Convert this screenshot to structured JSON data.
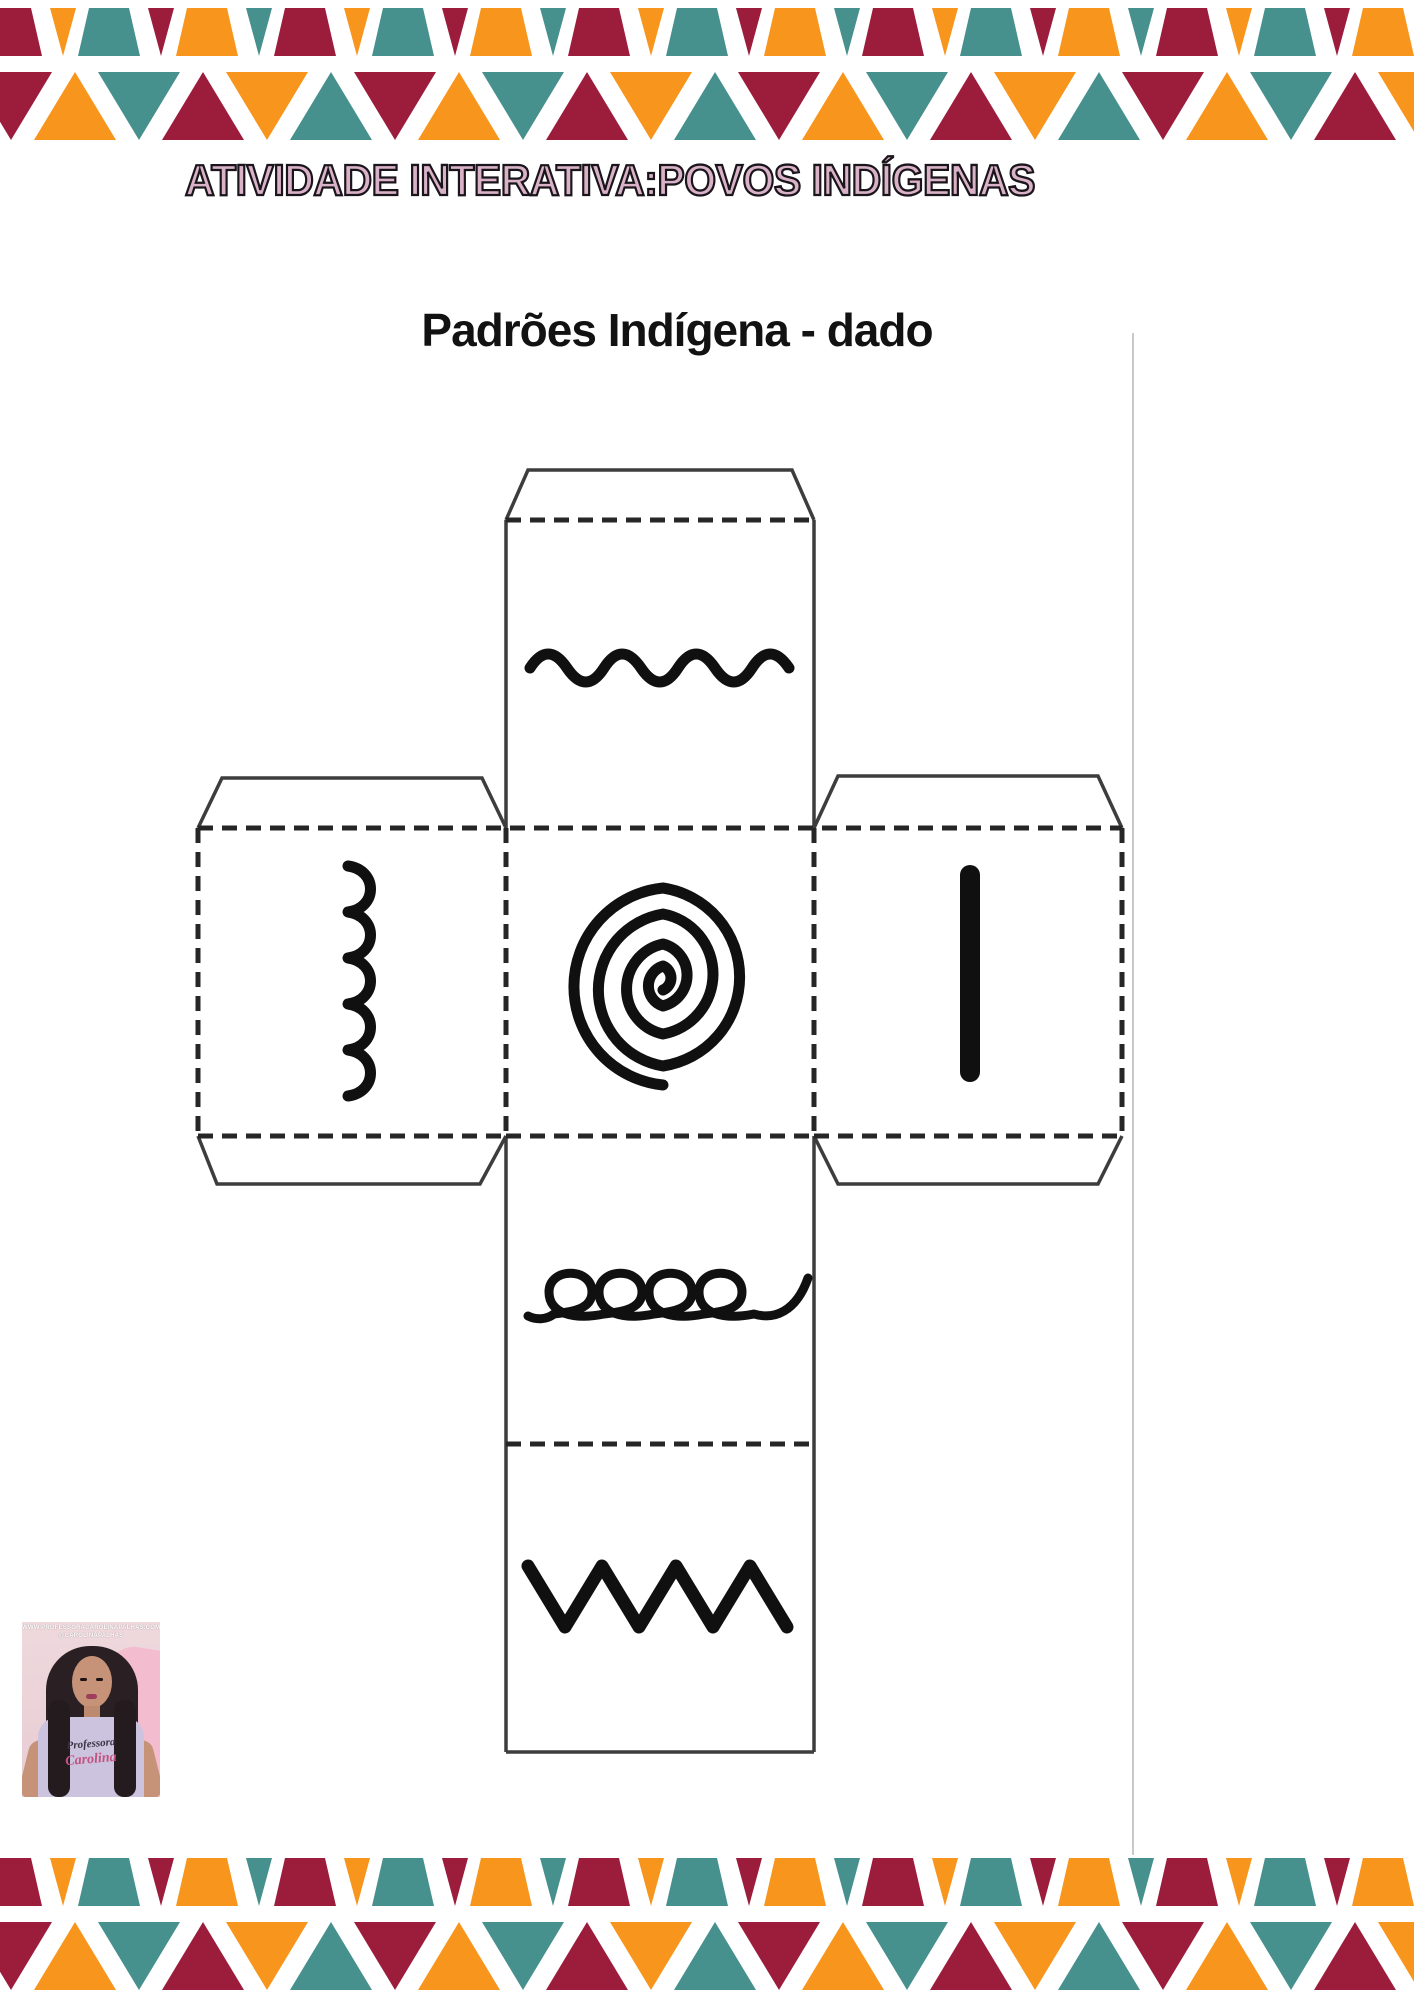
{
  "header": {
    "title": "ATIVIDADE INTERATIVA:POVOS INDÍGENAS"
  },
  "worksheet": {
    "subtitle": "Padrões Indígena - dado"
  },
  "dice": {
    "description": "cube net (dado) with indigenous pattern icons",
    "faces": [
      {
        "position": "top",
        "icon": "horizontal-wave-pattern-icon"
      },
      {
        "position": "left",
        "icon": "vertical-scallop-pattern-icon"
      },
      {
        "position": "center",
        "icon": "spiral-pattern-icon"
      },
      {
        "position": "right",
        "icon": "vertical-line-pattern-icon"
      },
      {
        "position": "bottom",
        "icon": "loops-pattern-icon"
      },
      {
        "position": "base",
        "icon": "zigzag-pattern-icon"
      }
    ]
  },
  "credit": {
    "website": "WWW.PROFESSORACAROLINAPALHAS.COM",
    "handle": "@CAROLINAPALHAS",
    "shirt_line1": "Professora",
    "shirt_line2": "Carolina"
  },
  "theme": {
    "triangle_colors": [
      "#9C1C3C",
      "#F8951C",
      "#46908D"
    ],
    "title_fill": "#D9B2C8",
    "title_outline": "#1A151B",
    "line_color": "#3D3D3D",
    "pattern_color": "#101010",
    "divider_grey": "#C9C9C9"
  }
}
